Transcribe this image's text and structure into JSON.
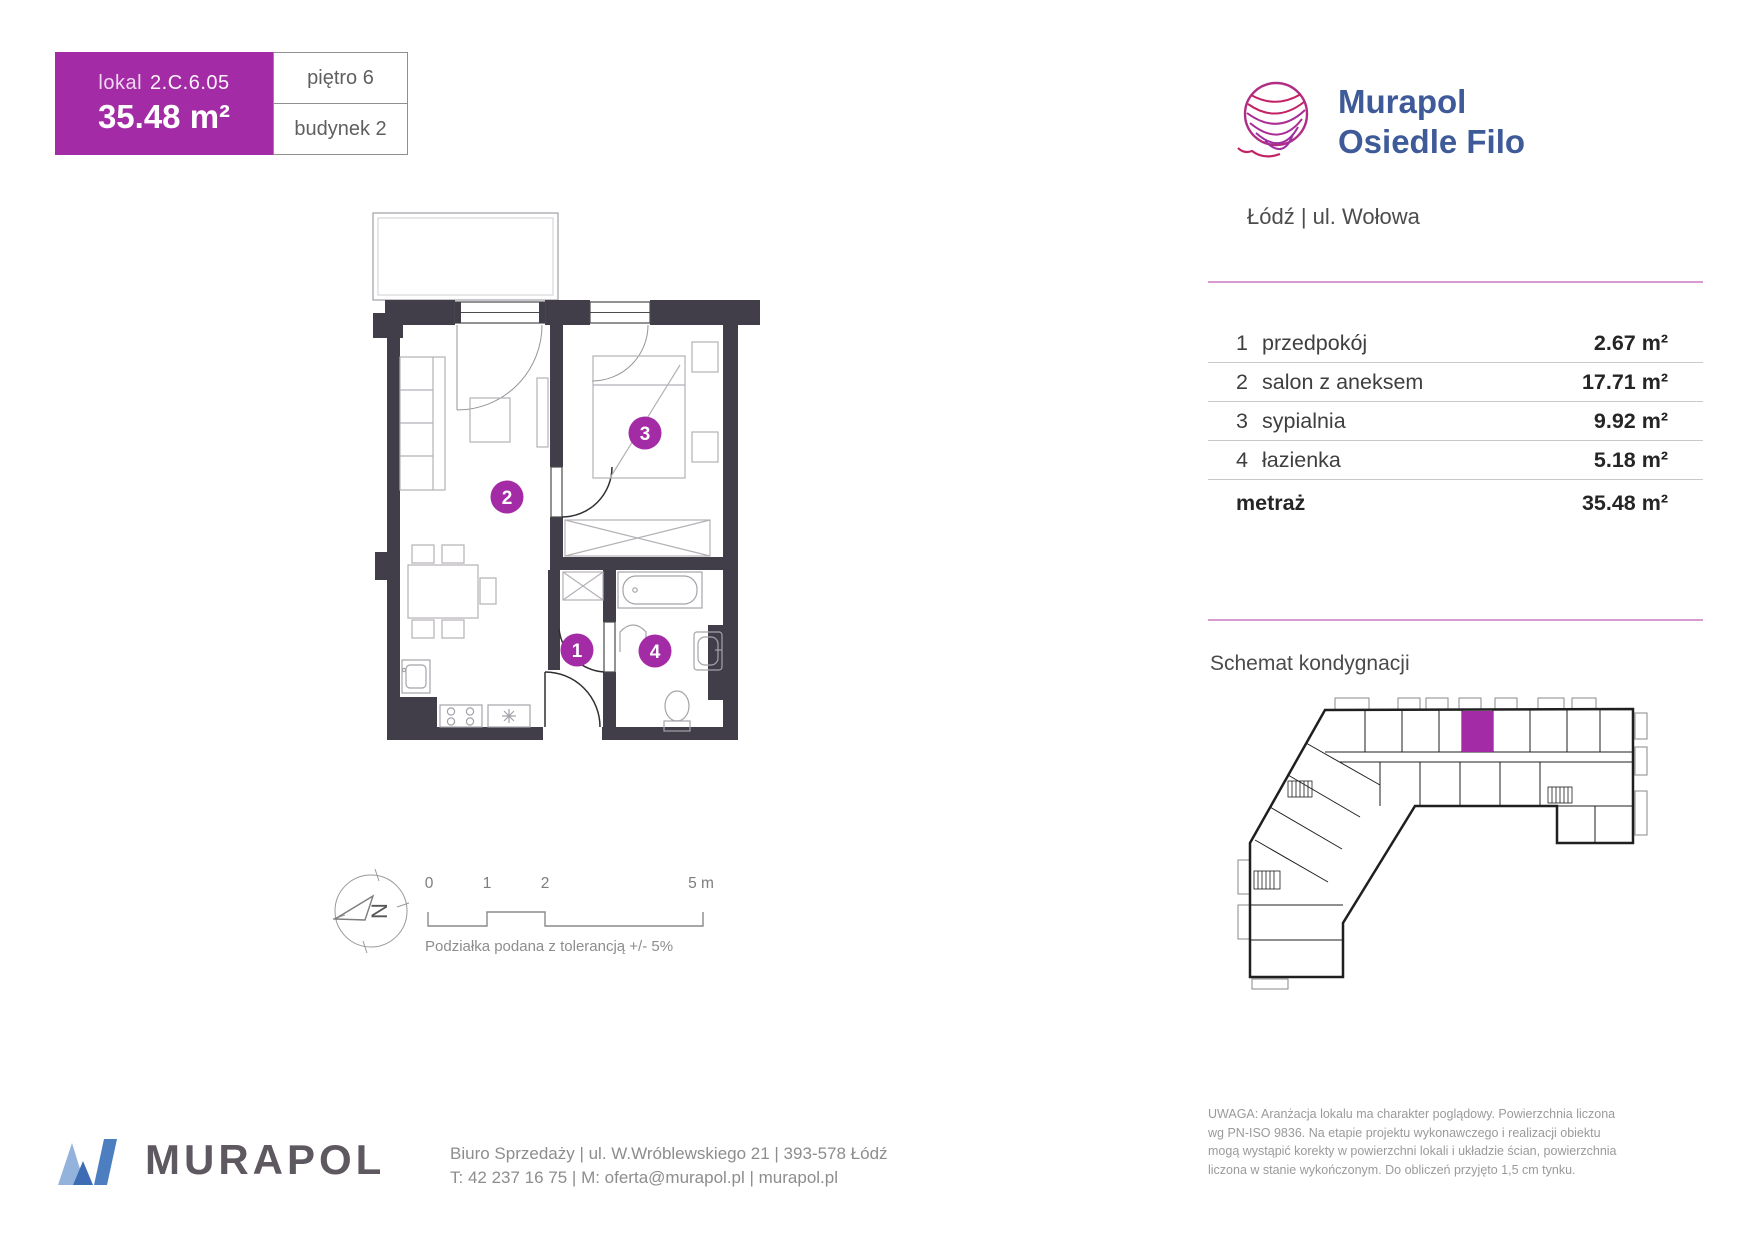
{
  "header": {
    "lokal_label": "lokal",
    "lokal_number": "2.C.6.05",
    "area": "35.48 m²",
    "floor": "piętro 6",
    "building": "budynek 2"
  },
  "brand": {
    "line1": "Murapol",
    "line2": "Osiedle Filo",
    "location": "Łódź | ul. Wołowa"
  },
  "rooms": {
    "rows": [
      {
        "num": "1",
        "name": "przedpokój",
        "area": "2.67 m²"
      },
      {
        "num": "2",
        "name": "salon z aneksem",
        "area": "17.71 m²"
      },
      {
        "num": "3",
        "name": "sypialnia",
        "area": "9.92 m²"
      },
      {
        "num": "4",
        "name": "łazienka",
        "area": "5.18 m²"
      }
    ],
    "total_label": "metraż",
    "total_area": "35.48 m²"
  },
  "floor_schematic_title": "Schemat kondygnacji",
  "badges": {
    "b1": "1",
    "b2": "2",
    "b3": "3",
    "b4": "4"
  },
  "compass_letter": "N",
  "scale": {
    "t0": "0",
    "t1": "1",
    "t2": "2",
    "t3": "5 m",
    "caption": "Podziałka podana z tolerancją +/- 5%"
  },
  "footer": {
    "logo": "MURAPOL",
    "address": "Biuro Sprzedaży | ul. W.Wróblewskiego 21 | 393-578 Łódź",
    "contact": "T: 42 237 16 75 | M: oferta@murapol.pl | murapol.pl"
  },
  "disclaimer": {
    "l1": "UWAGA: Aranżacja lokalu ma charakter poglądowy. Powierzchnia liczona",
    "l2": "wg PN-ISO 9836. Na etapie projektu wykonawczego i realizacji  obiektu",
    "l3": "mogą wystąpić korekty w powierzchni lokali i układzie ścian, powierzchnia",
    "l4": "liczona w stanie wykończonym. Do obliczeń przyjęto 1,5 cm tynku."
  },
  "colors": {
    "accent": "#A42BA6",
    "pink_line": "#D79AD2",
    "wall": "#413E4A",
    "brand_blue": "#3E5A99"
  }
}
